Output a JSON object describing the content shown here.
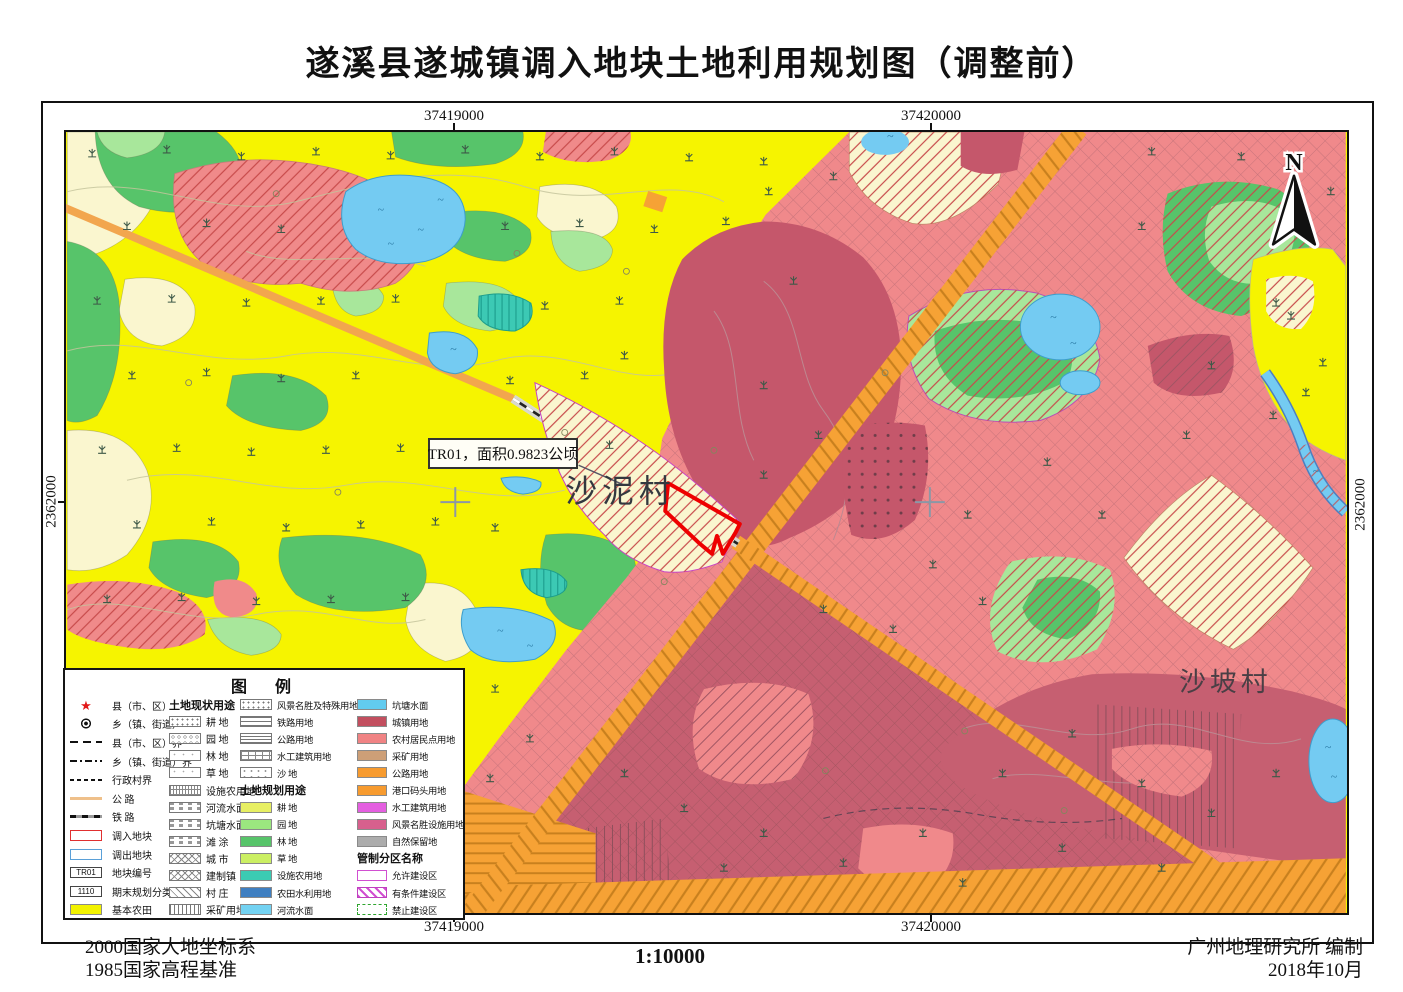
{
  "title": "遂溪县遂城镇调入地块土地利用规划图（调整前）",
  "map": {
    "grid_labels": {
      "top_left": "37419000",
      "top_right": "37420000",
      "bottom_left": "37419000",
      "bottom_right": "37420000",
      "left": "2362000",
      "right": "2362000"
    },
    "north_label": "N",
    "annotation": "TR01，面积0.9823公顷",
    "villages": [
      "沙泥村",
      "沙坡村"
    ]
  },
  "legend": {
    "title": "图　例",
    "columns": [
      {
        "entries": [
          {
            "sym": "star",
            "label": "县（市、区）"
          },
          {
            "sym": "town",
            "label": "乡（镇、街道）"
          },
          {
            "sym": "line-dash",
            "label": "县（市、区）界"
          },
          {
            "sym": "line-dashdot",
            "label": "乡（镇、街道）界"
          },
          {
            "sym": "line-finedash",
            "label": "行政村界"
          },
          {
            "sym": "line-road",
            "label": "公 路"
          },
          {
            "sym": "line-rail",
            "label": "铁 路"
          },
          {
            "sym": "box-red",
            "label": "调入地块"
          },
          {
            "sym": "box-blue",
            "label": "调出地块"
          },
          {
            "sym": "box-code",
            "text": "TR01",
            "label": "地块编号"
          },
          {
            "sym": "box-code",
            "text": "1110",
            "label": "期末规划分类编码"
          },
          {
            "sym": "sw",
            "color": "#F2F200",
            "label": "基本农田"
          }
        ]
      },
      {
        "entries": [
          {
            "h": "土地现状用途"
          },
          {
            "sym": "pat-dots",
            "label": "耕 地"
          },
          {
            "sym": "pat-rings",
            "label": "园 地"
          },
          {
            "sym": "pat-faint",
            "label": "林 地"
          },
          {
            "sym": "pat-faint",
            "label": "草 地"
          },
          {
            "sym": "pat-grid",
            "label": "设施农用地"
          },
          {
            "sym": "pat-dashrow",
            "label": "河流水面"
          },
          {
            "sym": "pat-dashrow",
            "label": "坑塘水面"
          },
          {
            "sym": "pat-dashrow",
            "label": "滩 涂"
          },
          {
            "sym": "pat-diamond",
            "label": "城 市"
          },
          {
            "sym": "pat-diamond",
            "label": "建制镇"
          },
          {
            "sym": "pat-diag",
            "label": "村 庄"
          },
          {
            "sym": "pat-vert",
            "label": "采矿用地"
          }
        ]
      },
      {
        "entries": [
          {
            "sym": "pat-dots",
            "label": "风景名胜及特殊用地"
          },
          {
            "sym": "pat-hlines",
            "label": "铁路用地"
          },
          {
            "sym": "pat-hlines2",
            "label": "公路用地"
          },
          {
            "sym": "pat-brick",
            "label": "水工建筑用地"
          },
          {
            "sym": "pat-dots2",
            "label": "沙 地"
          },
          {
            "h": "土地规划用途"
          },
          {
            "sym": "sw",
            "color": "#E7EF63",
            "label": "耕 地"
          },
          {
            "sym": "sw",
            "color": "#9BE77F",
            "label": "园 地"
          },
          {
            "sym": "sw",
            "color": "#57C46A",
            "label": "林 地"
          },
          {
            "sym": "sw",
            "color": "#CBEF63",
            "label": "草 地"
          },
          {
            "sym": "sw",
            "color": "#3BCBB3",
            "label": "设施农用地"
          },
          {
            "sym": "sw",
            "color": "#3F7FC1",
            "label": "农田水利用地"
          },
          {
            "sym": "sw",
            "color": "#73D2F2",
            "label": "河流水面"
          }
        ]
      },
      {
        "entries": [
          {
            "sym": "sw",
            "color": "#62CBEF",
            "label": "坑塘水面"
          },
          {
            "sym": "sw",
            "color": "#C24F5F",
            "label": "城镇用地"
          },
          {
            "sym": "sw",
            "color": "#F08384",
            "label": "农村居民点用地"
          },
          {
            "sym": "sw",
            "color": "#CD9F77",
            "label": "采矿用地"
          },
          {
            "sym": "sw",
            "color": "#F79B2F",
            "label": "公路用地"
          },
          {
            "sym": "sw",
            "color": "#F79B2F",
            "label": "港口码头用地"
          },
          {
            "sym": "sw",
            "color": "#E45FE0",
            "label": "水工建筑用地"
          },
          {
            "sym": "sw",
            "color": "#D7608D",
            "label": "风景名胜设施用地"
          },
          {
            "sym": "sw",
            "color": "#ACACAC",
            "label": "自然保留地"
          },
          {
            "h": "管制分区名称"
          },
          {
            "sym": "zone-allow",
            "label": "允许建设区"
          },
          {
            "sym": "zone-cond",
            "label": "有条件建设区"
          },
          {
            "sym": "zone-forbid",
            "label": "禁止建设区"
          }
        ]
      }
    ]
  },
  "footer": {
    "datum1": "2000国家大地坐标系",
    "datum2": "1985国家高程基准",
    "scale": "1:10000",
    "credit1": "广州地理研究所 编制",
    "credit2": "2018年10月"
  },
  "colors": {
    "basic_farmland": "#F6F400",
    "urban": "#C5576B",
    "rural_residential": "#F0898B",
    "road": "#F6A235",
    "pond_water": "#74CBF2",
    "forest": "#57C46A",
    "orchard": "#A8E79B",
    "transfer_in_outline": "#EE0000",
    "transfer_out_outline": "#5AA0D8",
    "conditional_zone_hatch": "#D14FD1"
  }
}
